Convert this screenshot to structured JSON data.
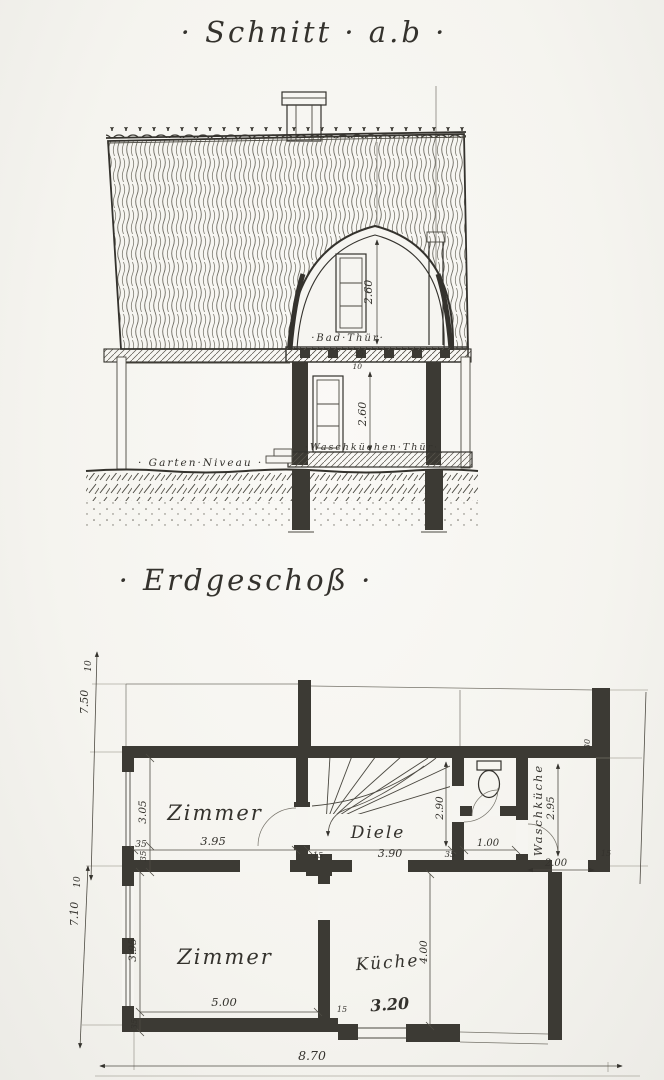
{
  "page": {
    "background": "#f6f5f1",
    "ink": "#34322d"
  },
  "section": {
    "title": "· Schnitt · a.b ·",
    "labels": {
      "bad_thuer": "·Bad·Thür·",
      "waschkuechen_thuer": "·Waschküchen·Thür·",
      "garten_niveau": "· Garten·Niveau ·"
    },
    "dims": {
      "attic_height": "2.60",
      "ground_height": "2.60",
      "floor_35": "35",
      "floor_10": "10"
    }
  },
  "plan": {
    "title": "· Erdgeschoß ·",
    "rooms": {
      "room_upper": "Zimmer",
      "hall": "Diele",
      "room_lower": "Zimmer",
      "kitchen": "Küche",
      "wash_kitchen": "Waschküche"
    },
    "dims": {
      "left_offset_upper": "10",
      "left_total_upper": "7.50",
      "left_offset_lower": "10",
      "left_total_lower": "7.10",
      "room_upper_depth": "3.05",
      "wall_35_a": "35",
      "room_upper_width": "3.95",
      "wall_15_a": "15",
      "hall_width": "3.90",
      "wall_35_b": "35",
      "wc_width": "1.00",
      "wash_width": "2.00",
      "wall_15_b": "15",
      "hall_depth": "2.90",
      "wash_depth": "2.95",
      "wash_offset": "30",
      "room_lower_depth": "3.95",
      "wall_35_c": "35",
      "room_lower_width": "5.00",
      "wall_15_c": "15",
      "kitchen_width": "3.20",
      "kitchen_depth": "4.00",
      "total_width": "8.70",
      "wall_35_d": "35"
    }
  }
}
